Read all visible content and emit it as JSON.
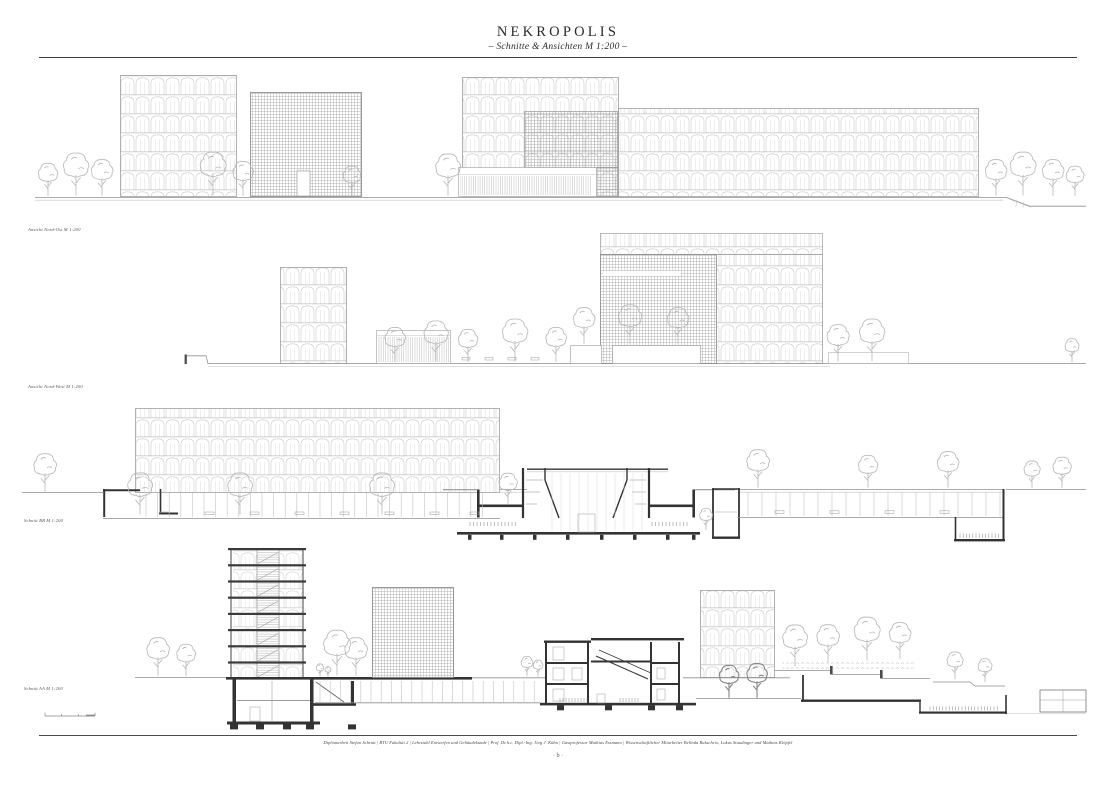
{
  "header": {
    "title": "NEKROPOLIS",
    "subtitle": "– Schnitte & Ansichten M 1:200 –"
  },
  "drawings": [
    {
      "label": "Ansicht Nord-Ost M 1:200"
    },
    {
      "label": "Ansicht Nord-West M 1:200"
    },
    {
      "label": "Schnitt BB M 1:200"
    },
    {
      "label": "Schnitt AA M 1:200"
    }
  ],
  "footer": {
    "credits": "Diplomarbeit Stefan Schratt | BTU Fakultät 2 | Lehrstuhl Entwerfen und Gebäudekunde | Prof. Dr.h.c. Dipl.-Ing. Jörg J. Kühn | Gastprofessor Mathias Essmann | Wissenschaftlicher Mitarbeiter Belinda Rukschcio, Lukas Staudinger und Mathias Klöpfel",
    "page_marker": "· b ·"
  },
  "colors": {
    "paper": "#ffffff",
    "ink": "#3d3d3d",
    "line_light": "#c6c6c6",
    "line_medium": "#a0a0a0",
    "section_dark": "#333333"
  }
}
